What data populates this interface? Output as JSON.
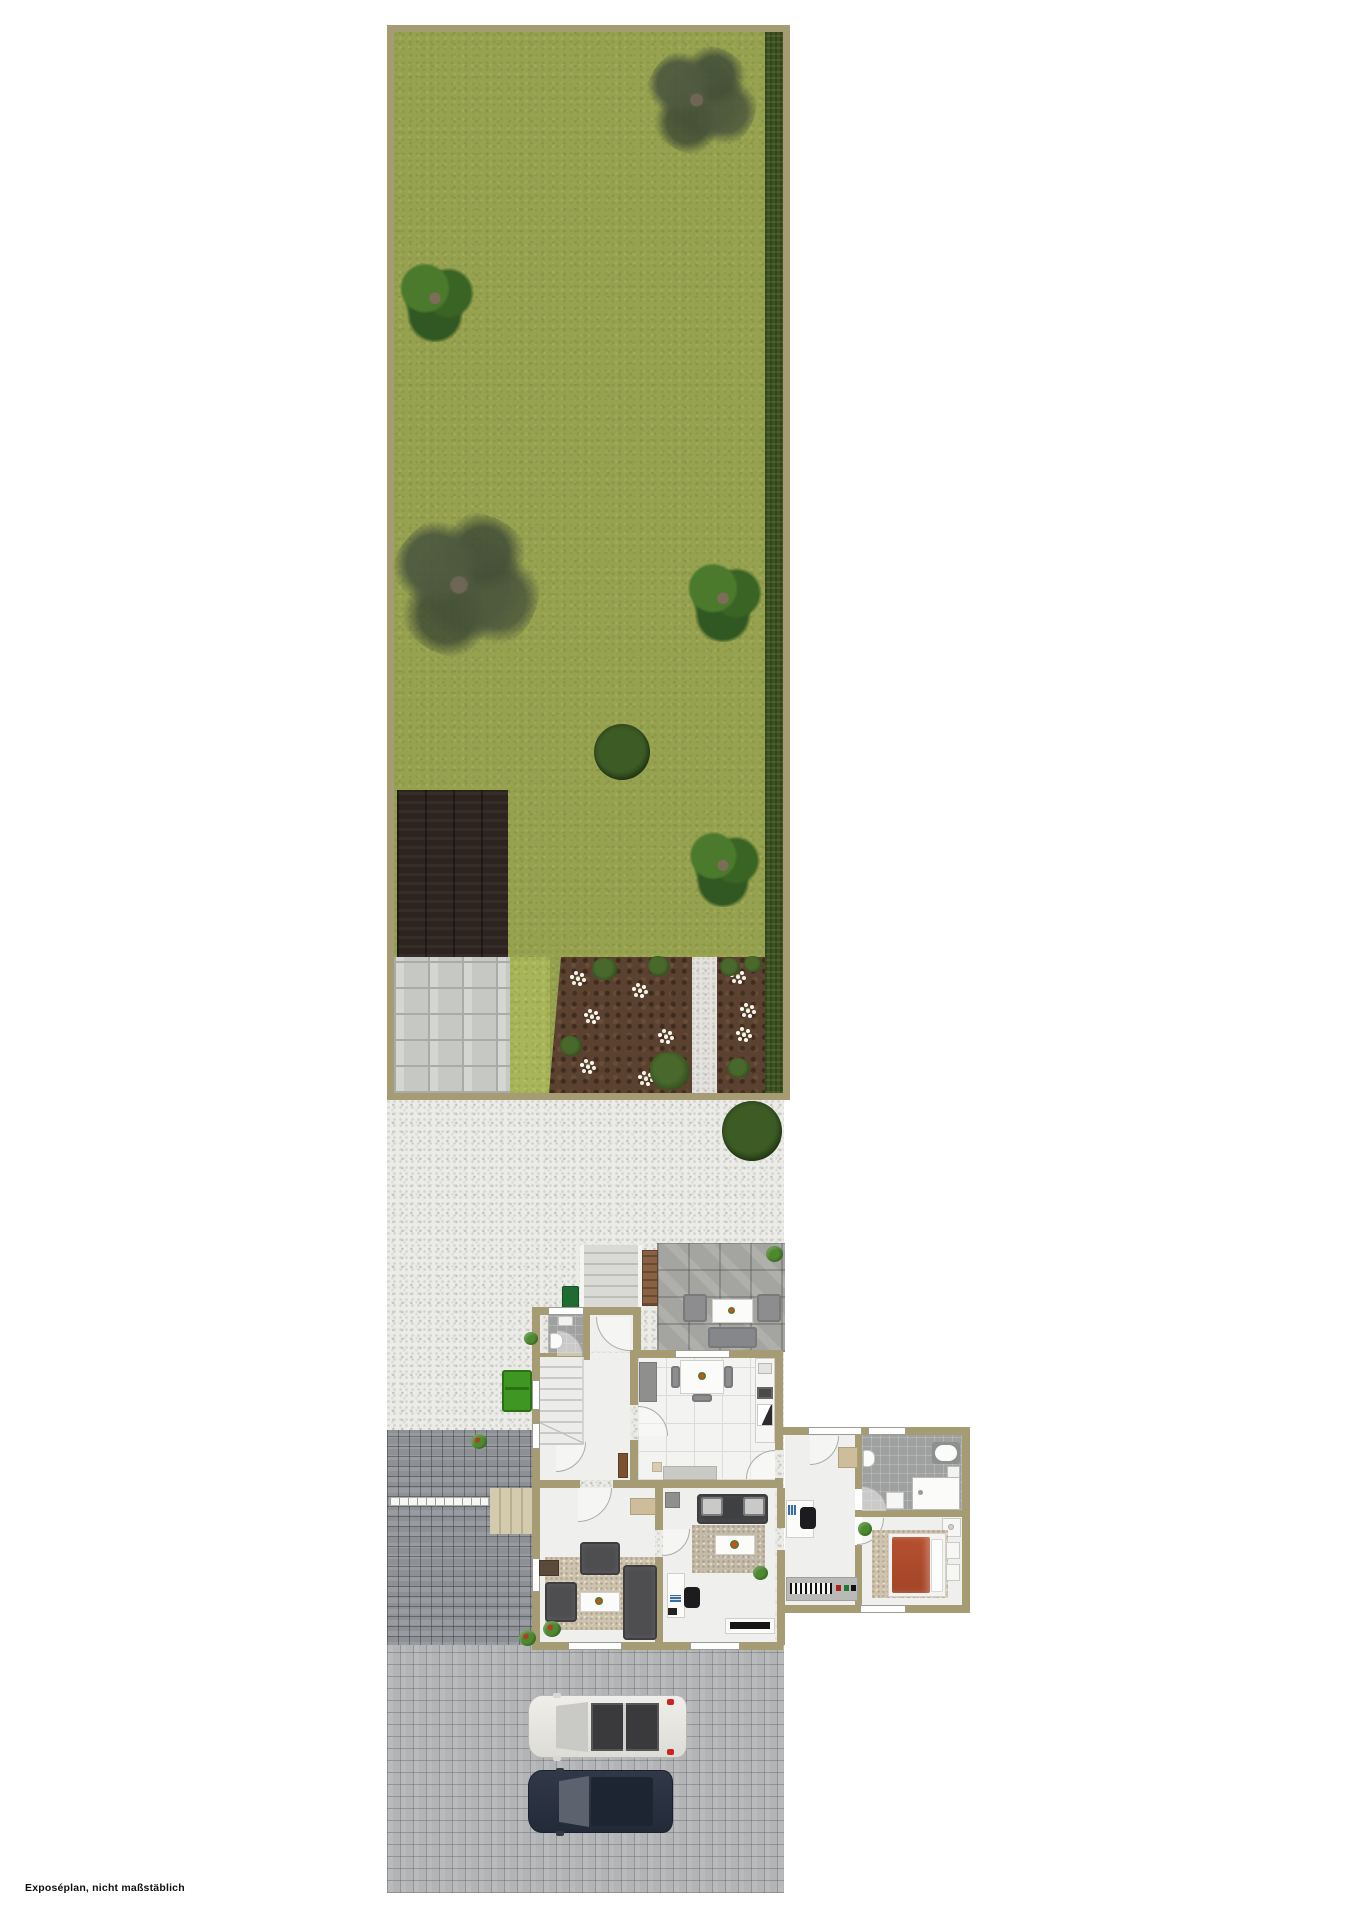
{
  "caption": "Exposéplan, nicht maßstäblich",
  "palette": {
    "lawn": "#97a251",
    "hedge": "#3c531f",
    "soil": "#5b4230",
    "gravel": "#ebebe8",
    "wall": "#a69c74",
    "deck": "#2e241f",
    "driveway": "#b2b4b6",
    "dark-pavers": "#8d9095",
    "stone-path": "#c6c8c4",
    "terrace": "#a4a5a0",
    "bed-duvet": "#b04a2e",
    "car-white": "#e9e8e3",
    "car-dark": "#2b3140",
    "bin-green": "#3f9623"
  },
  "plan": {
    "type": "real-estate exposé site & floor plan, top view",
    "sections": [
      "garden lawn with trees and hedge",
      "wood deck",
      "stone path",
      "flower beds with gravel path",
      "gravel courtyard",
      "house ground floor",
      "annex wing",
      "paved driveway"
    ],
    "garden": {
      "trees": [
        "scraggly-dark-tree",
        "leafy-tree",
        "large-scraggly-tree",
        "leafy-dark-tree",
        "round-bush",
        "leafy-bright-tree"
      ],
      "bush_on_gravel": 1,
      "flower_beds": 2,
      "flower_clusters_white": 9
    },
    "house_rooms": [
      "wc",
      "entry-hall",
      "staircase",
      "dining-kitchen",
      "living-room",
      "study",
      "wing-corridor",
      "bathroom",
      "bedroom"
    ],
    "outdoor_items": [
      "entrance-stairs",
      "terrace-lounge-set",
      "wooden-bench",
      "green-bins",
      "side-stoop",
      "gate"
    ],
    "vehicles": [
      {
        "name": "white-suv",
        "facing": "left"
      },
      {
        "name": "dark-blue-car",
        "facing": "left"
      }
    ]
  }
}
